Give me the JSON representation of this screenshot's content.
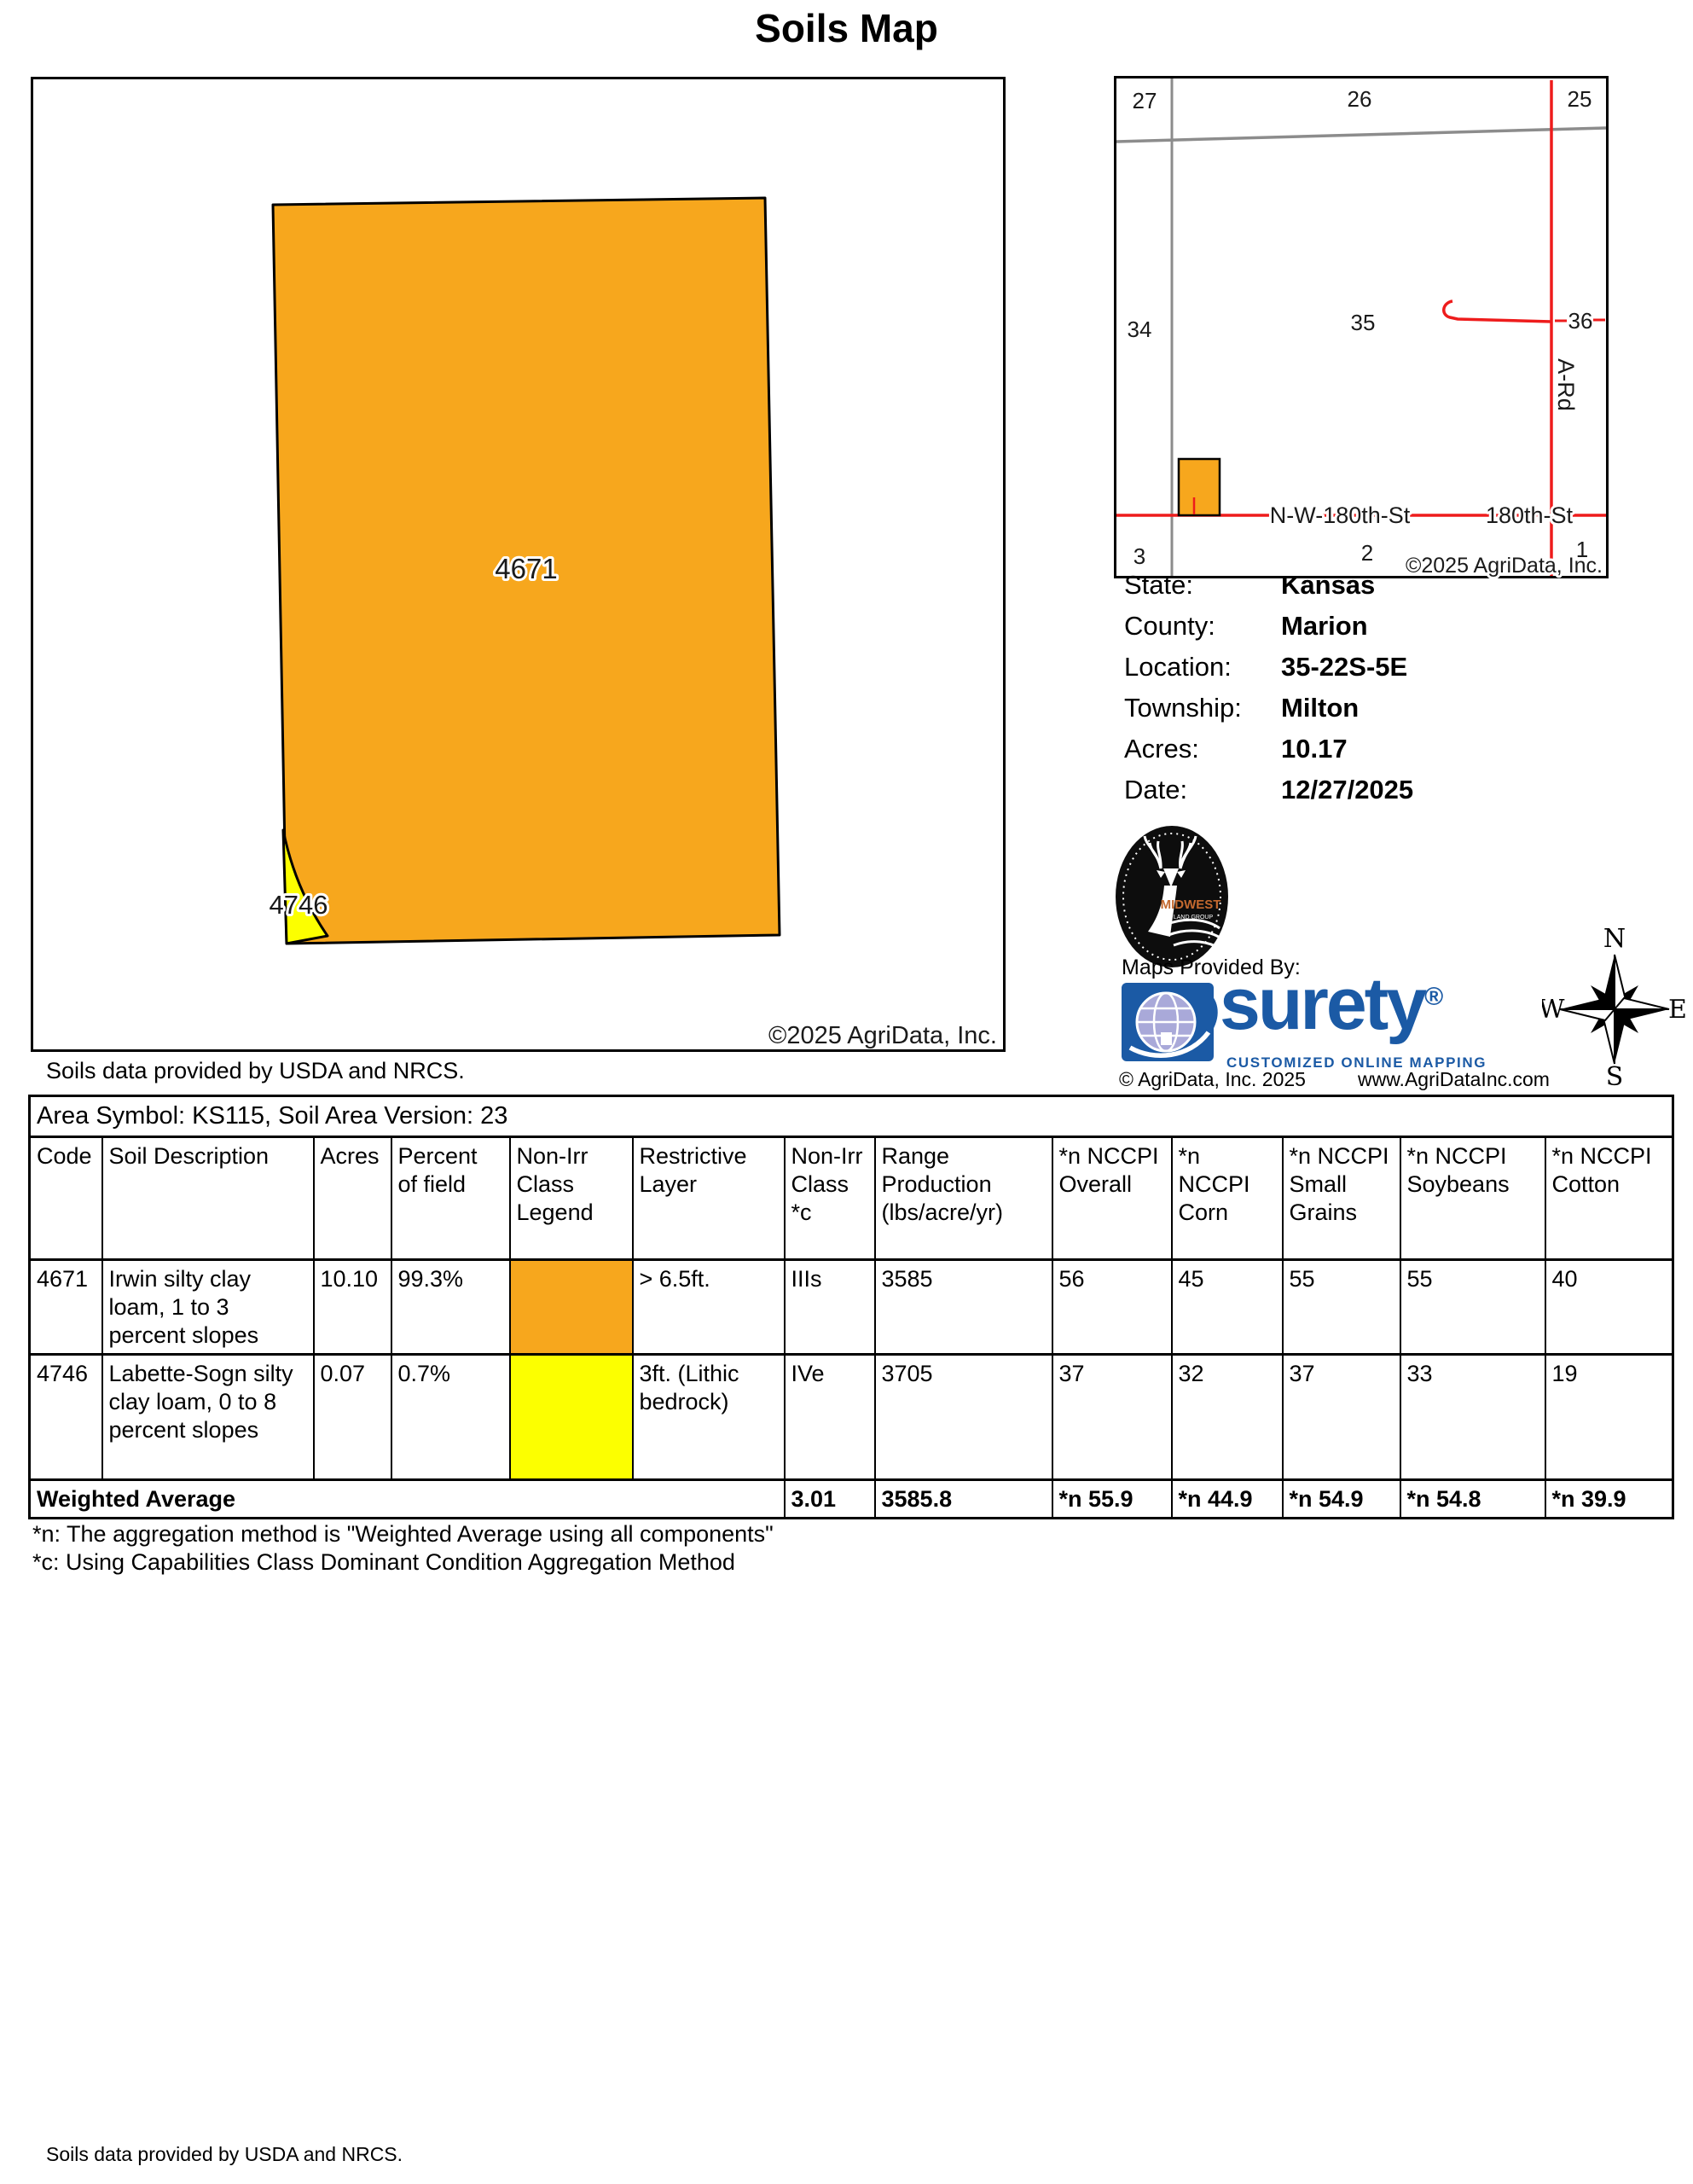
{
  "page": {
    "title": "Soils Map"
  },
  "main_map": {
    "labels": {
      "field_4671": "4671",
      "field_4746": "4746"
    },
    "copyright": "©2025 AgriData, Inc.",
    "soils_note": "Soils data provided by USDA and NRCS."
  },
  "locator_map": {
    "sections": {
      "s27": "27",
      "s26": "26",
      "s25": "25",
      "s34": "34",
      "s35": "35",
      "s36": "36",
      "s3": "3",
      "s2": "2",
      "s1": "1"
    },
    "roads": {
      "nw_180th": "N-W-180th-St",
      "e_180th": "180th-St",
      "a_rd": "A-Rd"
    },
    "copyright": "©2025 AgriData, Inc."
  },
  "info": {
    "rows": [
      {
        "label": "State:",
        "value": "Kansas"
      },
      {
        "label": "County:",
        "value": "Marion"
      },
      {
        "label": "Location:",
        "value": "35-22S-5E"
      },
      {
        "label": "Township:",
        "value": "Milton"
      },
      {
        "label": "Acres:",
        "value": "10.17"
      },
      {
        "label": "Date:",
        "value": "12/27/2025"
      }
    ]
  },
  "branding": {
    "maps_provided_by": "Maps Provided By:",
    "surety_name": "surety",
    "surety_reg": "®",
    "surety_tagline": "CUSTOMIZED ONLINE MAPPING",
    "agridata_copyright": "© AgriData, Inc. 2025",
    "agridata_website": "www.AgriDataInc.com",
    "midwest_name": "MIDWEST",
    "midwest_sub": "LAND GROUP"
  },
  "compass": {
    "north": "N",
    "south": "S",
    "east": "E",
    "west": "W"
  },
  "soil_table": {
    "area_symbol_line": "Area Symbol: KS115, Soil Area Version: 23",
    "headers": [
      "Code",
      "Soil Description",
      "Acres",
      "Percent of field",
      "Non-Irr Class Legend",
      "Restrictive Layer",
      "Non-Irr Class *c",
      "Range Production (lbs/acre/yr)",
      "*n NCCPI Overall",
      "*n NCCPI Corn",
      "*n NCCPI Small Grains",
      "*n NCCPI Soybeans",
      "*n NCCPI Cotton"
    ],
    "rows": [
      {
        "code": "4671",
        "description": "Irwin silty clay loam, 1 to 3 percent slopes",
        "acres": "10.10",
        "percent": "99.3%",
        "legend_color": "#F7A71D",
        "restrictive_layer": "> 6.5ft.",
        "non_irr_class": "IIIs",
        "range_production": "3585",
        "nccpi_overall": "56",
        "nccpi_corn": "45",
        "nccpi_small_grains": "55",
        "nccpi_soybeans": "55",
        "nccpi_cotton": "40"
      },
      {
        "code": "4746",
        "description": "Labette-Sogn silty clay loam, 0 to 8 percent slopes",
        "acres": "0.07",
        "percent": "0.7%",
        "legend_color": "#FCFF00",
        "restrictive_layer": "3ft. (Lithic bedrock)",
        "non_irr_class": "IVe",
        "range_production": "3705",
        "nccpi_overall": "37",
        "nccpi_corn": "32",
        "nccpi_small_grains": "37",
        "nccpi_soybeans": "33",
        "nccpi_cotton": "19"
      }
    ],
    "weighted_average": {
      "label": "Weighted Average",
      "non_irr_class": "3.01",
      "range_production": "3585.8",
      "nccpi_overall": "*n 55.9",
      "nccpi_corn": "*n 44.9",
      "nccpi_small_grains": "*n 54.9",
      "nccpi_soybeans": "*n 54.8",
      "nccpi_cotton": "*n 39.9"
    },
    "footnotes": [
      "*n: The aggregation method is \"Weighted Average using all components\"",
      "*c: Using Capabilities Class Dominant Condition Aggregation Method"
    ]
  },
  "footer": {
    "soils_note": "Soils data provided by USDA and NRCS."
  },
  "colors": {
    "soil_orange": "#F7A71D",
    "soil_yellow": "#FCFF00",
    "road_red": "#EE1C1C",
    "line_gray": "#8C8C8C",
    "surety_blue": "#1B5AA5",
    "globe_lavender": "#A9A9D9",
    "midwest_orange": "#C4692F"
  }
}
